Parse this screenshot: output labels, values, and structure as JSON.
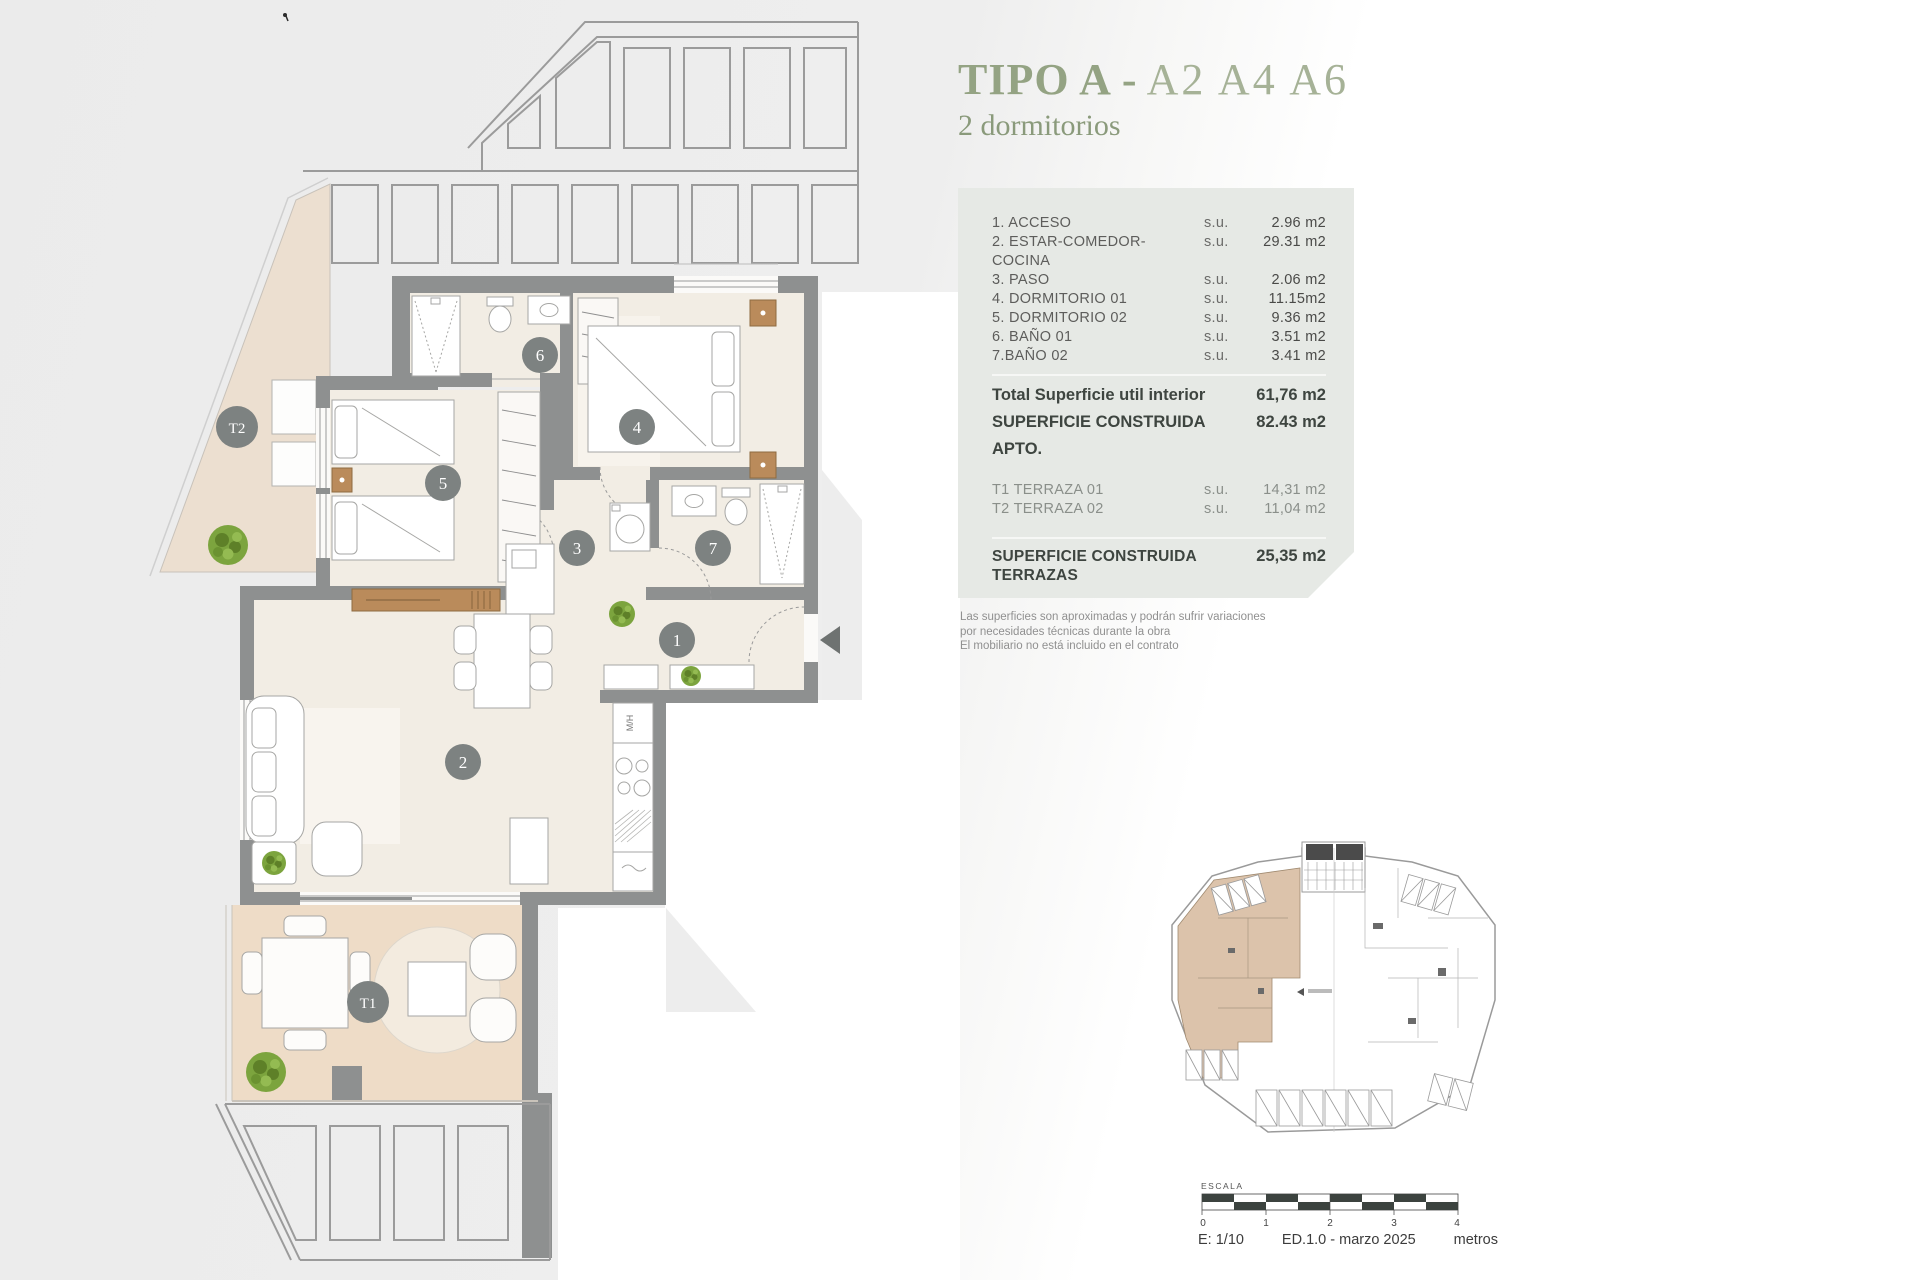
{
  "header": {
    "title": "TIPO A",
    "separator": "-",
    "units": "A2 A4 A6",
    "subtitle": "2 dormitorios"
  },
  "panel": {
    "rooms": [
      {
        "label": "1. ACCESO",
        "su": "s.u.",
        "value": "2.96 m2"
      },
      {
        "label": "2. ESTAR-COMEDOR-COCINA",
        "su": "s.u.",
        "value": "29.31 m2"
      },
      {
        "label": "3. PASO",
        "su": "s.u.",
        "value": "2.06 m2"
      },
      {
        "label": "4. DORMITORIO 01",
        "su": "s.u.",
        "value": "11.15m2"
      },
      {
        "label": "5. DORMITORIO 02",
        "su": "s.u.",
        "value": "9.36 m2"
      },
      {
        "label": "6. BAÑO 01",
        "su": "s.u.",
        "value": "3.51 m2"
      },
      {
        "label": "7.BAÑO 02",
        "su": "s.u.",
        "value": "3.41 m2"
      }
    ],
    "interior_total": {
      "label": "Total Superficie util interior",
      "value": "61,76 m2"
    },
    "built_apartment": {
      "label": "SUPERFICIE CONSTRUIDA APTO.",
      "value": "82.43 m2"
    },
    "terraces": [
      {
        "label": "T1 TERRAZA 01",
        "su": "s.u.",
        "value": "14,31 m2"
      },
      {
        "label": "T2 TERRAZA 02",
        "su": "s.u.",
        "value": "11,04 m2"
      }
    ],
    "built_terraces": {
      "label": "SUPERFICIE CONSTRUIDA TERRAZAS",
      "value": "25,35 m2"
    },
    "total": {
      "label": "SUPERFICIE TOTAL APARTAMENTO",
      "value": "107,78 m2"
    }
  },
  "disclaimer": {
    "line1": "Las superficies son aproximadas y podrán sufrir variaciones",
    "line2": "por necesidades técnicas durante la obra",
    "line3": "El mobiliario no está incluido en el contrato"
  },
  "scalebar": {
    "title": "ESCALA",
    "ticks": [
      "0",
      "1",
      "2",
      "3",
      "4"
    ],
    "scale": "E: 1/10",
    "edition": "ED.1.0 - marzo 2025",
    "units_label": "metros"
  },
  "plan": {
    "room_labels": {
      "t2": "T2",
      "n5": "5",
      "n6": "6",
      "n4": "4",
      "n3": "3",
      "n7": "7",
      "n1": "1",
      "n2": "2",
      "t1": "T1"
    },
    "kitchen_appliance": "M/H"
  },
  "colors": {
    "title_green": "#94a383",
    "accent_orange": "#c3814e",
    "panel_bg": "#e6e9e5",
    "wall_gray": "#8e9090",
    "circle_gray": "#7d8281",
    "floor_cream": "#f2ede4",
    "terrace_t2": "#ecdfd0",
    "terrace_t1": "#eedcc7",
    "unit_highlight": "#dcc3ab",
    "wood": "#ba8b5b",
    "plant_green": "#7fa33b"
  }
}
